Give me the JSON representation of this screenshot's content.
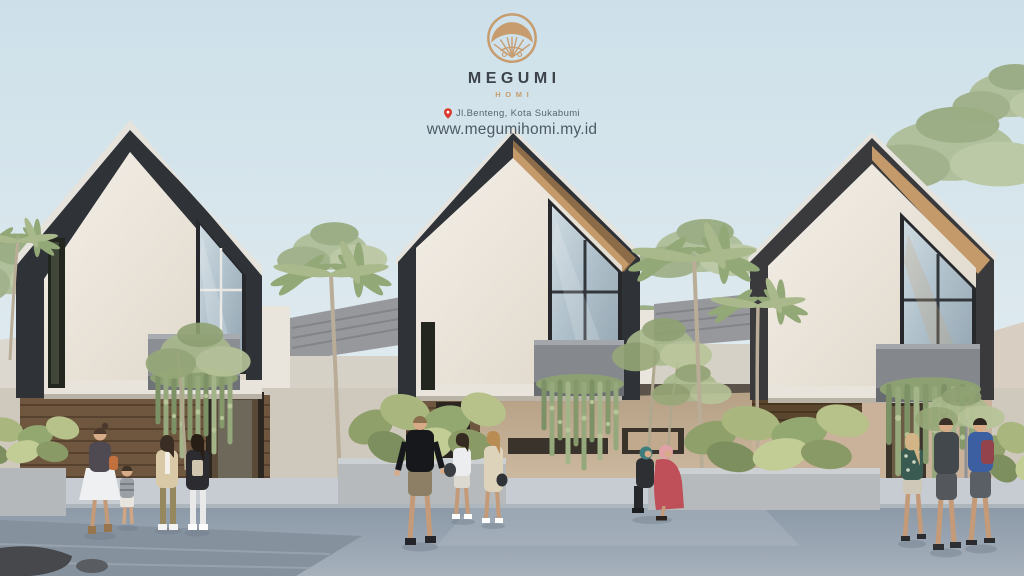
{
  "poster": {
    "brand": {
      "name": "MEGUMI",
      "subname": "HOMI",
      "logo_icon": "fan-circle-logo-icon"
    },
    "location": {
      "pin_icon": "location-pin-icon",
      "address": "Jl.Benteng, Kota Sukabumi"
    },
    "website": "www.megumihomi.my.id"
  },
  "scene": {
    "type": "architectural-exterior-render",
    "houses": 3,
    "elements": [
      "gable-townhouse",
      "balcony-planter",
      "hanging-vines",
      "palm-tree",
      "tropical-shrub-planter",
      "wood-slat-facade",
      "pedestrians",
      "sidewalk",
      "road"
    ]
  },
  "palette": {
    "sky": "#cde0e9",
    "roof_dark": "#2f3237",
    "wall_warm_white": "#efe9df",
    "wood_accent": "#c49a6a",
    "wood_slats": "#6e563f",
    "beige_wall": "#c9b299",
    "foliage": "#97a878",
    "pavement": "#93a0ac",
    "logo_tan": "#c79c6f",
    "text_dark": "#3d434b",
    "pin_red": "#d93a2b"
  }
}
